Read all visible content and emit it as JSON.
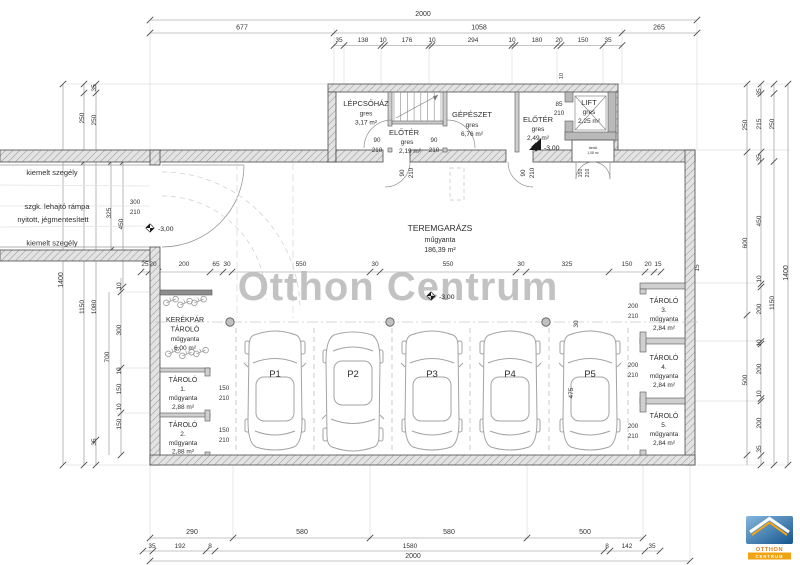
{
  "watermark": "Otthon Centrum",
  "rooms": {
    "stairwell": {
      "name": "LÉPCSŐHÁZ",
      "finish": "gres",
      "area": "3,17 m²"
    },
    "foyer1": {
      "name": "ELŐTÉR",
      "finish": "gres",
      "area": "2,19 m²"
    },
    "mechanical": {
      "name": "GÉPÉSZET",
      "finish": "gres",
      "area": "6,76 m²"
    },
    "foyer2": {
      "name": "ELŐTÉR",
      "finish": "gres",
      "area": "2,49 m²"
    },
    "lift": {
      "name": "LIFT",
      "finish": "gres",
      "area": "2,25 m²"
    },
    "annex": {
      "name": "tároló",
      "area": "1,08 m²"
    },
    "garage": {
      "name": "TEREMGARÁZS",
      "finish": "műgyanta",
      "area": "186,39 m²"
    },
    "bike": {
      "name1": "KERÉKPÁR",
      "name2": "TÁROLÓ",
      "finish": "műgyanta",
      "area": "6,00 m²"
    },
    "storage1": {
      "name": "TÁROLÓ",
      "num": "1.",
      "finish": "műgyanta",
      "area": "2,88 m²"
    },
    "storage2": {
      "name": "TÁROLÓ",
      "num": "2.",
      "finish": "műgyanta",
      "area": "2,88 m²"
    },
    "storage3": {
      "name": "TÁROLÓ",
      "num": "3.",
      "finish": "műgyanta",
      "area": "2,84 m²"
    },
    "storage4": {
      "name": "TÁROLÓ",
      "num": "4.",
      "finish": "műgyanta",
      "area": "2,84 m²"
    },
    "storage5": {
      "name": "TÁROLÓ",
      "num": "5.",
      "finish": "műgyanta",
      "area": "2,84 m²"
    }
  },
  "parking": {
    "p1": "P1",
    "p2": "P2",
    "p3": "P3",
    "p4": "P4",
    "p5": "P5"
  },
  "site": {
    "curb_top": "kiemelt szegély",
    "ramp_line1": "szgk. lehajtó rámpa",
    "ramp_line2": "nyitott, jégmentesített",
    "curb_bottom": "kiemelt szegély"
  },
  "levels": {
    "ramp": "-3,00",
    "foyer": "-3,00",
    "garage": "-3,00"
  },
  "doors": {
    "ramp": {
      "w": "300",
      "h": "210"
    },
    "foyer1_left": {
      "w": "90",
      "h": "210"
    },
    "foyer1_right": {
      "w": "90",
      "h": "210"
    },
    "garage_door1": {
      "w": "90",
      "h": "210"
    },
    "garage_door2": {
      "w": "90",
      "h": "210"
    },
    "lift_door": {
      "w": "85",
      "h": "210"
    },
    "annex_door": {
      "w": "150",
      "h": "210"
    },
    "storage1_door": {
      "w": "150",
      "h": "210"
    },
    "storage2_door": {
      "w": "150",
      "h": "210"
    },
    "storage3_door": {
      "w": "200",
      "h": "210"
    },
    "storage4_door": {
      "w": "200",
      "h": "210"
    },
    "storage5_door": {
      "w": "200",
      "h": "210"
    }
  },
  "dims": {
    "top_total": "2000",
    "top_row2": [
      "677",
      "1058",
      "265"
    ],
    "top_row3": [
      "35",
      "138",
      "10",
      "176",
      "10",
      "294",
      "10",
      "180",
      "20",
      "150",
      "35"
    ],
    "mid_row": [
      "25",
      "20",
      "200",
      "65",
      "30",
      "550",
      "30",
      "550",
      "30",
      "325",
      "150",
      "20",
      "15"
    ],
    "bottom_row1": [
      "290",
      "580",
      "580",
      "500"
    ],
    "bottom_row2": [
      "35",
      "192",
      "8",
      "1580",
      "8",
      "142",
      "35"
    ],
    "bottom_total": "2000",
    "left_outer": "1400",
    "left_row": [
      "250",
      "1150",
      "35",
      "250",
      "1080",
      "35",
      "325",
      "450",
      "10",
      "300",
      "700",
      "10",
      "150",
      "10",
      "150"
    ],
    "right_row": [
      "250",
      "600",
      "500",
      "35",
      "215",
      "35",
      "450",
      "10",
      "200",
      "10",
      "200",
      "10",
      "200",
      "35",
      "250",
      "1150",
      "1400",
      "15"
    ],
    "garage_inner": [
      "30",
      "475"
    ],
    "misc": [
      "10"
    ]
  },
  "logo": {
    "name": "OTTHON",
    "sub": "CENTRUM"
  }
}
